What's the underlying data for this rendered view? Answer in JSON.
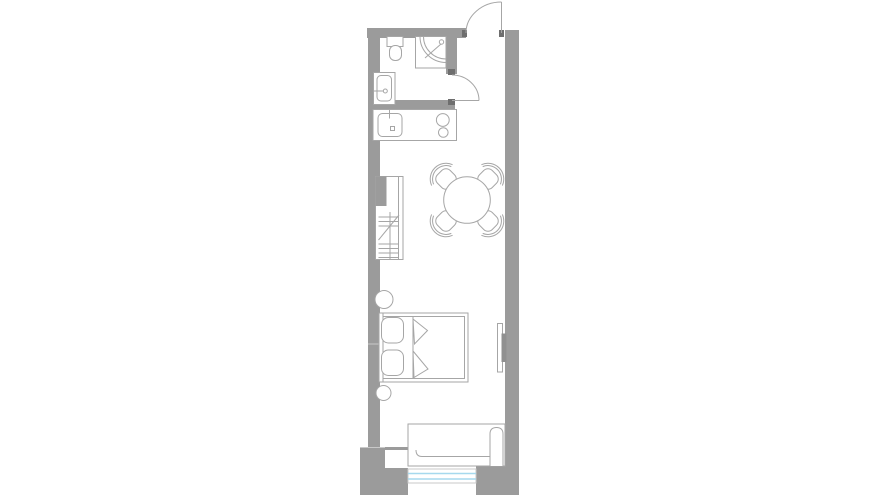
{
  "page": {
    "kind": "architectural-floor-plan",
    "background": "#ffffff"
  },
  "colors": {
    "wall": "#9b9b9b",
    "jamb": "#6e6e6e",
    "line": "#a6a6a6",
    "line_light": "#c9c9c9",
    "glass": "#a6d9ee",
    "background": "#ffffff"
  },
  "floorplan": {
    "layout": "narrow-studio-apartment",
    "rooms": [
      "bathroom",
      "kitchenette",
      "living-sleeping-area"
    ],
    "fixtures": [
      "entry-door-with-swing",
      "bathroom-door-with-swing",
      "toilet",
      "corner-shower",
      "bathroom-sink",
      "kitchen-counter",
      "kitchen-sink",
      "cooktop-two-burners",
      "wardrobe-with-hangers",
      "round-dining-table",
      "dining-chair-x4",
      "round-nightstand-x2",
      "double-bed-with-pillows",
      "wall-mounted-tv",
      "sofa",
      "window-double-glazing"
    ]
  }
}
